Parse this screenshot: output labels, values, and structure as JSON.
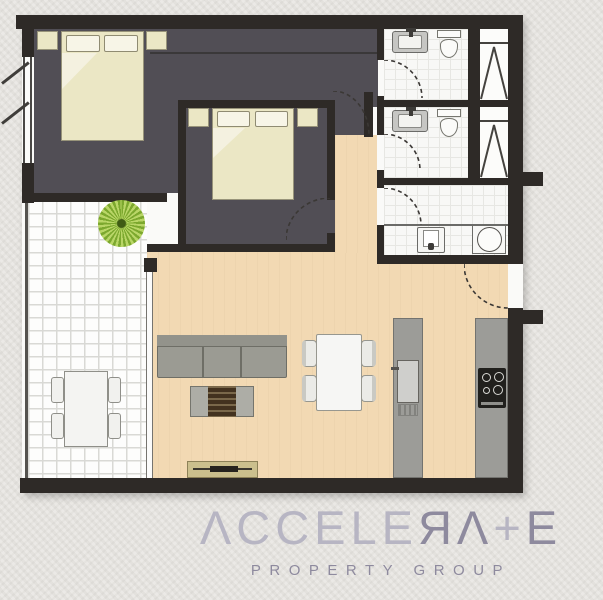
{
  "logo": {
    "segments": [
      {
        "text": "ΛCCELE",
        "tone": "light"
      },
      {
        "text": "ЯΛ",
        "tone": "dark"
      },
      {
        "text": "+",
        "tone": "light"
      },
      {
        "text": "E",
        "tone": "dark"
      }
    ],
    "tagline": "PROPERTY GROUP"
  },
  "palette": {
    "bg": "#e9e7e3",
    "wall": "#2e2a27",
    "bedroom-floor": "#514e55",
    "living-floor": "#f2d9b3",
    "bed": "#ebe7c5",
    "counter": "#9c9c98",
    "sofa": "#9b9b93",
    "tv-unit": "#cbbf8d",
    "plant-green": "#8fb83e",
    "logo-light": "#b7b5c3",
    "logo-dark": "#8e8a9e"
  },
  "icons": {
    "plant": "round-plant-icon",
    "wardrobe": "triangle-hanging-rail-symbol",
    "door_swing": "dashed-quarter-arc",
    "window": "double-line-with-strokes"
  }
}
